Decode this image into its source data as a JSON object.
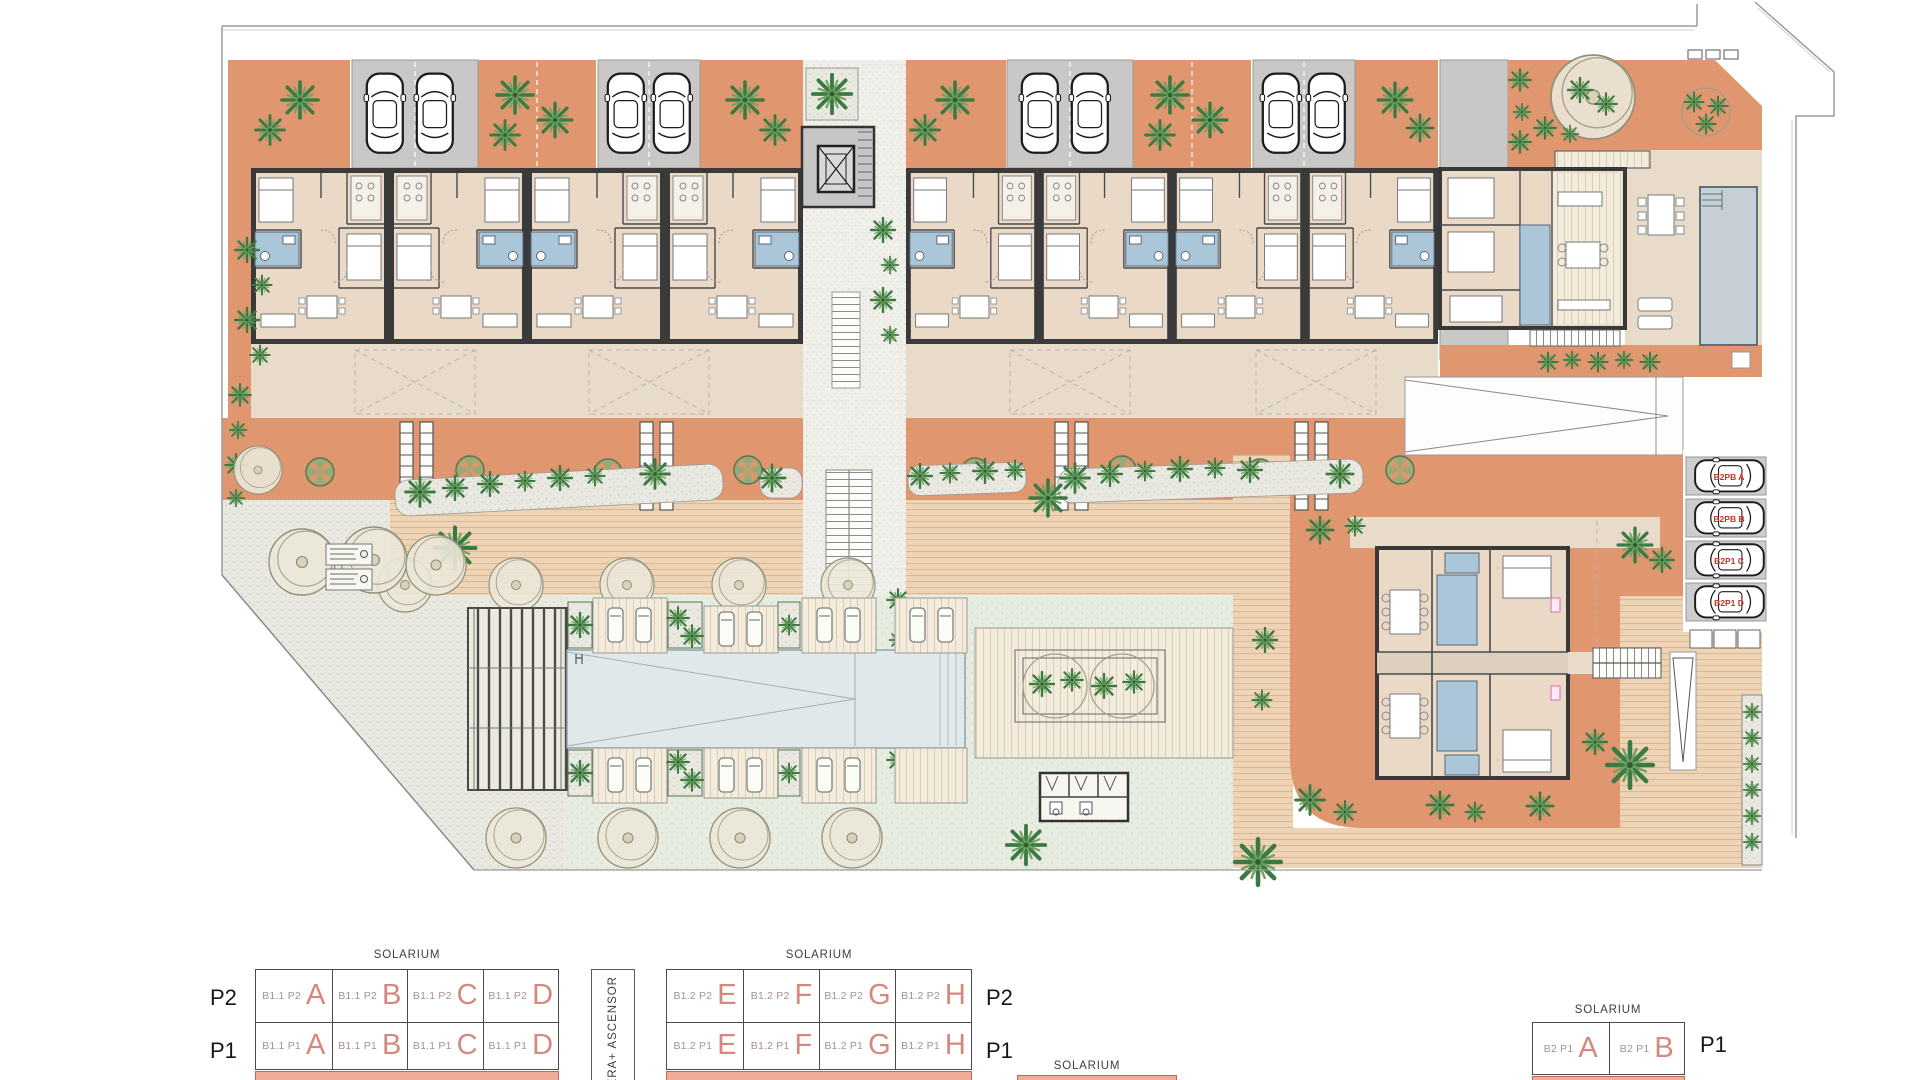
{
  "title": "Residential complex site plan",
  "legend": {
    "stairs_elevator_label": "ESCALERA+ ASCENSOR",
    "extra_solarium": "SOLARIUM",
    "tables": [
      {
        "solarium": "SOLARIUM",
        "rows": [
          {
            "floor": "P2",
            "cells": [
              {
                "code": "B1.1 P2",
                "unit": "A"
              },
              {
                "code": "B1.1 P2",
                "unit": "B"
              },
              {
                "code": "B1.1 P2",
                "unit": "C"
              },
              {
                "code": "B1.1 P2",
                "unit": "D"
              }
            ]
          },
          {
            "floor": "P1",
            "cells": [
              {
                "code": "B1.1 P1",
                "unit": "A"
              },
              {
                "code": "B1.1 P1",
                "unit": "B"
              },
              {
                "code": "B1.1 P1",
                "unit": "C"
              },
              {
                "code": "B1.1 P1",
                "unit": "D"
              }
            ]
          }
        ]
      },
      {
        "solarium": "SOLARIUM",
        "rows": [
          {
            "floor": "P2",
            "cells": [
              {
                "code": "B1.2 P2",
                "unit": "E"
              },
              {
                "code": "B1.2 P2",
                "unit": "F"
              },
              {
                "code": "B1.2 P2",
                "unit": "G"
              },
              {
                "code": "B1.2 P2",
                "unit": "H"
              }
            ]
          },
          {
            "floor": "P1",
            "cells": [
              {
                "code": "B1.2 P1",
                "unit": "E"
              },
              {
                "code": "B1.2 P1",
                "unit": "F"
              },
              {
                "code": "B1.2 P1",
                "unit": "G"
              },
              {
                "code": "B1.2 P1",
                "unit": "H"
              }
            ]
          }
        ]
      },
      {
        "solarium": "SOLARIUM",
        "rows": [
          {
            "floor": "P1",
            "cells": [
              {
                "code": "B2 P1",
                "unit": "A"
              },
              {
                "code": "B2 P1",
                "unit": "B"
              }
            ]
          }
        ]
      }
    ]
  },
  "plan": {
    "parking_space_labels": [
      "B2PB A",
      "B2PB B",
      "B2P1 C",
      "B2P1 D"
    ]
  },
  "colors": {
    "terrace_orange": "#e0966e",
    "floor_beige": "#ead9c6",
    "patio_beige": "#e8dbc9",
    "bathroom_blue": "#abc6d9",
    "communal_pool": "#e1e8ea",
    "villa_pool": "#c6cfd4",
    "parking_gray": "#c9c8c6",
    "walkway_tan": "#eed4b6",
    "plant_green": "#3c7a45",
    "wall_dark": "#3a3a3a",
    "unit_letter_salmon": "#d5897e",
    "parking_label_red": "#c63226",
    "solarium_stub_salmon": "#f0ac99"
  }
}
